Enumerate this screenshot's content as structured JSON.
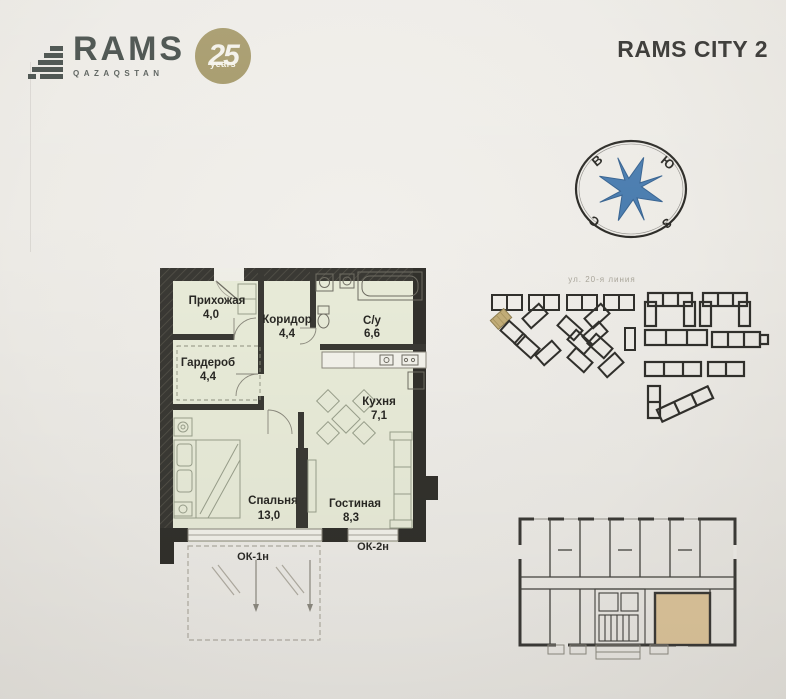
{
  "brand": {
    "name": "RAMS",
    "country": "QAZAQSTAN",
    "badge": {
      "number": "25",
      "label": "years",
      "color": "#a69a6b"
    }
  },
  "header": {
    "title": "RAMS CITY 2"
  },
  "compass": {
    "east": "В",
    "south": "Ю",
    "west": "З",
    "north": "С",
    "star_color": "#4c7eb0"
  },
  "floor_plan": {
    "rooms": [
      {
        "name": "Прихожая",
        "area": "4,0"
      },
      {
        "name": "Коридор",
        "area": "4,4"
      },
      {
        "name": "Гардероб",
        "area": "4,4"
      },
      {
        "name": "С/у",
        "area": "6,6"
      },
      {
        "name": "Кухня",
        "area": "7,1"
      },
      {
        "name": "Спальня",
        "area": "13,0"
      },
      {
        "name": "Гостиная",
        "area": "8,3"
      }
    ],
    "windows": [
      {
        "label": "ОК-1н"
      },
      {
        "label": "ОК-2н"
      }
    ],
    "floor_color": "#e9ecd9",
    "wall_color": "#3a3934"
  },
  "site_plan": {
    "street": "ул. 20-я линия",
    "highlighted_building_color": "#c3ae78"
  },
  "overview_plan": {
    "highlighted_unit_color": "#dcc49a"
  }
}
